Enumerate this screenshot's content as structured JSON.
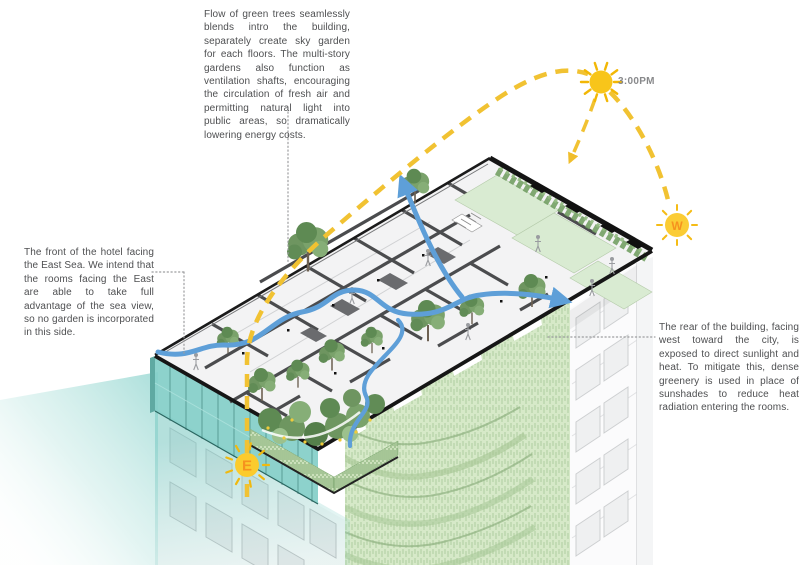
{
  "annotations": {
    "top_note": "Flow of green trees seamlessly blends intro the building, separately create sky garden for each floors. The multi-story gardens also function as ventilation shafts, encouraging the circulation of fresh air and permitting natural light into public areas, so dramatically lowering energy costs.",
    "left_note": "The front of the hotel facing the East Sea. We intend that the rooms facing the East are able to take full advantage of the sea view, so no garden is incorporated in this side.",
    "right_note": "The rear of the building, facing west toward the city, is exposed to direct sunlight and heat. To mitigate this, dense greenery is used in place of sunshades to reduce heat radiation entering the rooms."
  },
  "sun": {
    "time": "3:00PM"
  },
  "markers": {
    "east": "E",
    "west": "W"
  },
  "colors": {
    "sun_yellow": "#F2C232",
    "airflow_blue": "#5E9FD8",
    "greenery_green": "#6E9660",
    "sea_view_teal": "#7ECEC7",
    "green_facade": "#D6E9C8"
  }
}
